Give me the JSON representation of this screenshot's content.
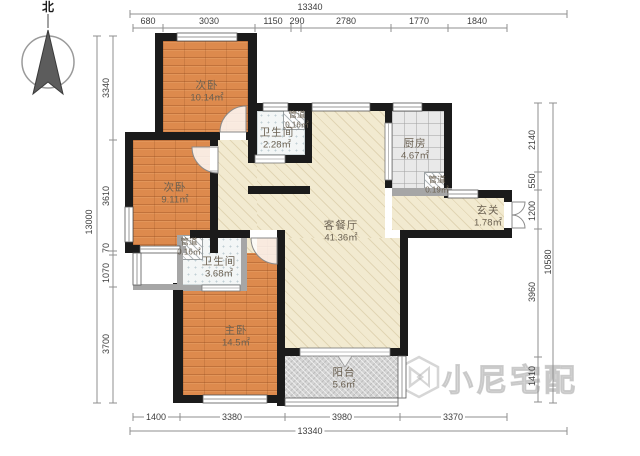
{
  "north_label": "北",
  "rooms": {
    "bed_top": {
      "name": "次卧",
      "area": "10.14㎡"
    },
    "bed_mid": {
      "name": "次卧",
      "area": "9.11㎡"
    },
    "master": {
      "name": "主卧",
      "area": "14.5㎡"
    },
    "bath_top": {
      "name": "卫生间",
      "area": "2.28㎡"
    },
    "bath_mid": {
      "name": "卫生间",
      "area": "3.68㎡"
    },
    "kitchen": {
      "name": "厨房",
      "area": "4.67㎡"
    },
    "living": {
      "name": "客餐厅",
      "area": "41.36㎡"
    },
    "entry": {
      "name": "玄关",
      "area": "1.78㎡"
    },
    "balcony": {
      "name": "阳台",
      "area": "5.6㎡"
    },
    "duct_top": {
      "name": "管道",
      "area": "0.16㎡"
    },
    "duct_kitchen": {
      "name": "管道",
      "area": "0.19㎡"
    },
    "duct_mid": {
      "name": "管道",
      "area": "0.16㎡"
    }
  },
  "dimensions": {
    "top_total": "13340",
    "top": [
      "680",
      "3030",
      "1150",
      "290",
      "2780",
      "1770",
      "1840"
    ],
    "bottom_total": "13340",
    "bottom": [
      "1400",
      "3380",
      "3980",
      "3370"
    ],
    "left_total": "13000",
    "left": [
      "3340",
      "3610",
      "70",
      "1070",
      "3700"
    ],
    "right_total": "10580",
    "right": [
      "2140",
      "550",
      "1200",
      "3960",
      "1410"
    ]
  },
  "watermark": {
    "text": "小尼宅配"
  }
}
